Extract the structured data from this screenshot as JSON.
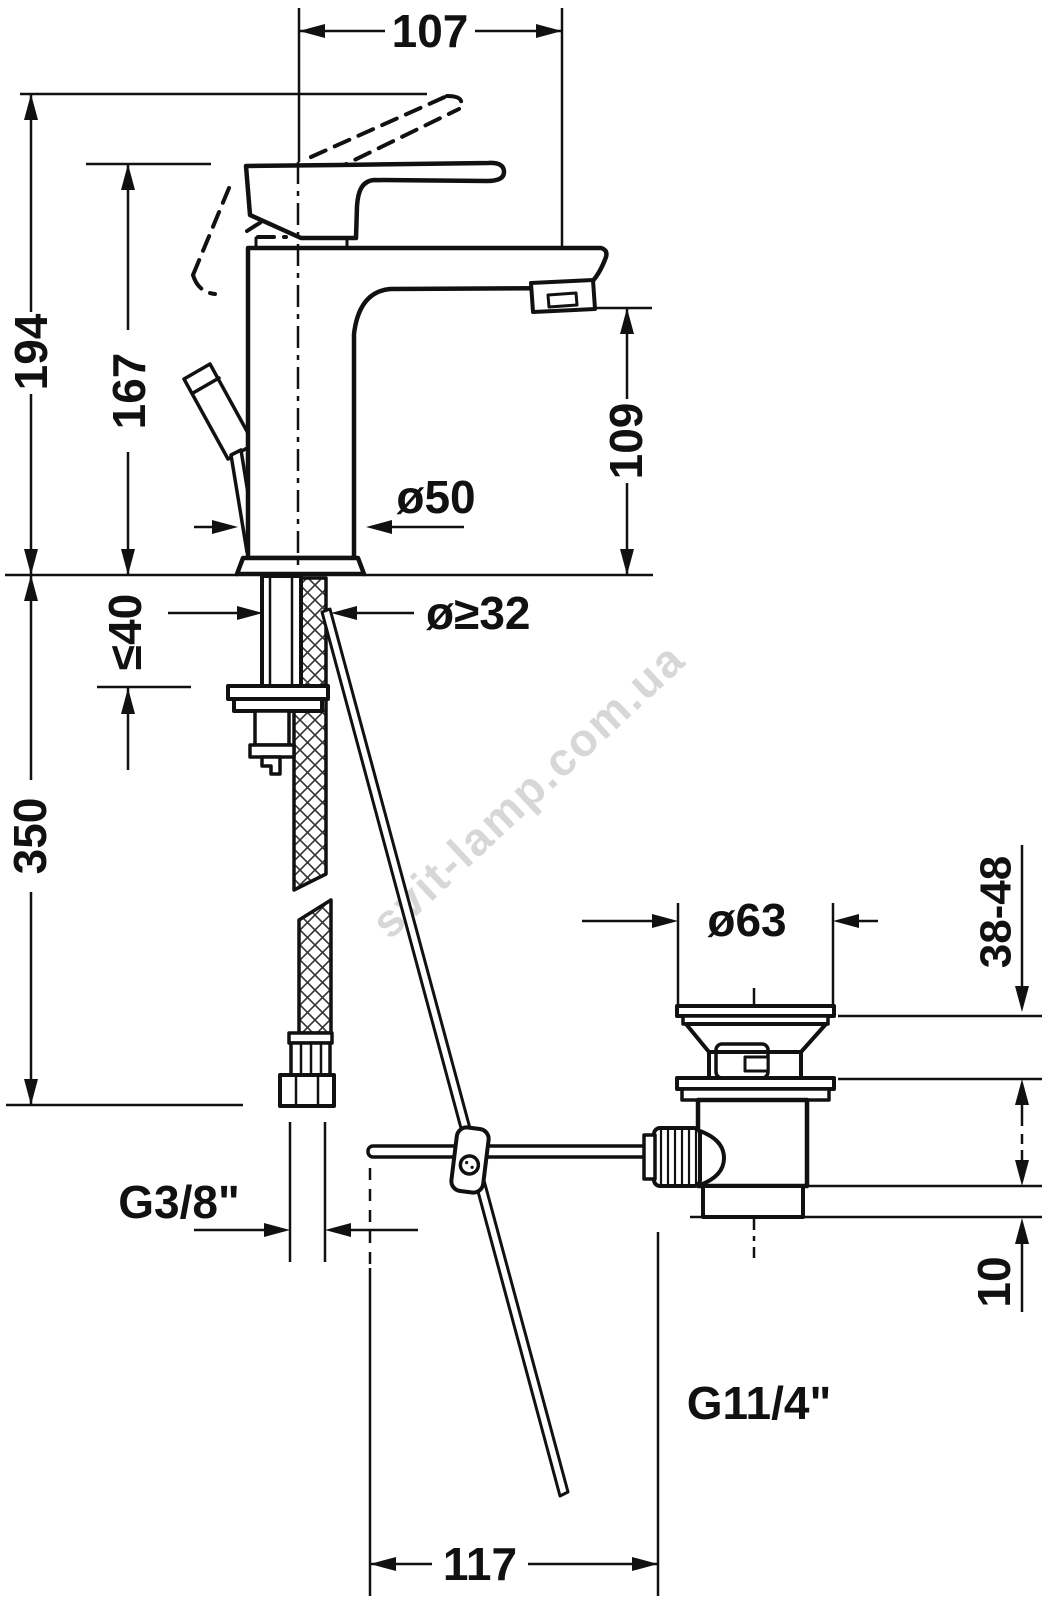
{
  "drawing": {
    "type": "technical-dimension-diagram",
    "subject": "Single-lever basin mixer faucet with flexible supply hose and pop-up waste drain, side elevation",
    "background_color": "#ffffff",
    "line_color": "#111111",
    "watermark": {
      "text": "svit-lamp.com.ua",
      "color": "#c9c9c9",
      "rotation_deg": -43
    }
  },
  "dimensions": {
    "spout_projection": {
      "label": "107"
    },
    "total_height": {
      "label": "194"
    },
    "body_height": {
      "label": "167"
    },
    "spout_outlet_height": {
      "label": "109"
    },
    "base_diameter": {
      "label": "ø50"
    },
    "mounting_hole_diameter": {
      "label": "ø≥32"
    },
    "max_deck_thickness": {
      "label": "≤40"
    },
    "hose_length": {
      "label": "350"
    },
    "drain_flange_diameter": {
      "label": "ø63"
    },
    "basin_thickness_range": {
      "label": "38-48"
    },
    "supply_thread": {
      "label": "G3/8\""
    },
    "drain_step_height": {
      "label": "10"
    },
    "drain_thread": {
      "label": "G11/4\""
    },
    "rod_horizontal_offset": {
      "label": "117"
    }
  }
}
